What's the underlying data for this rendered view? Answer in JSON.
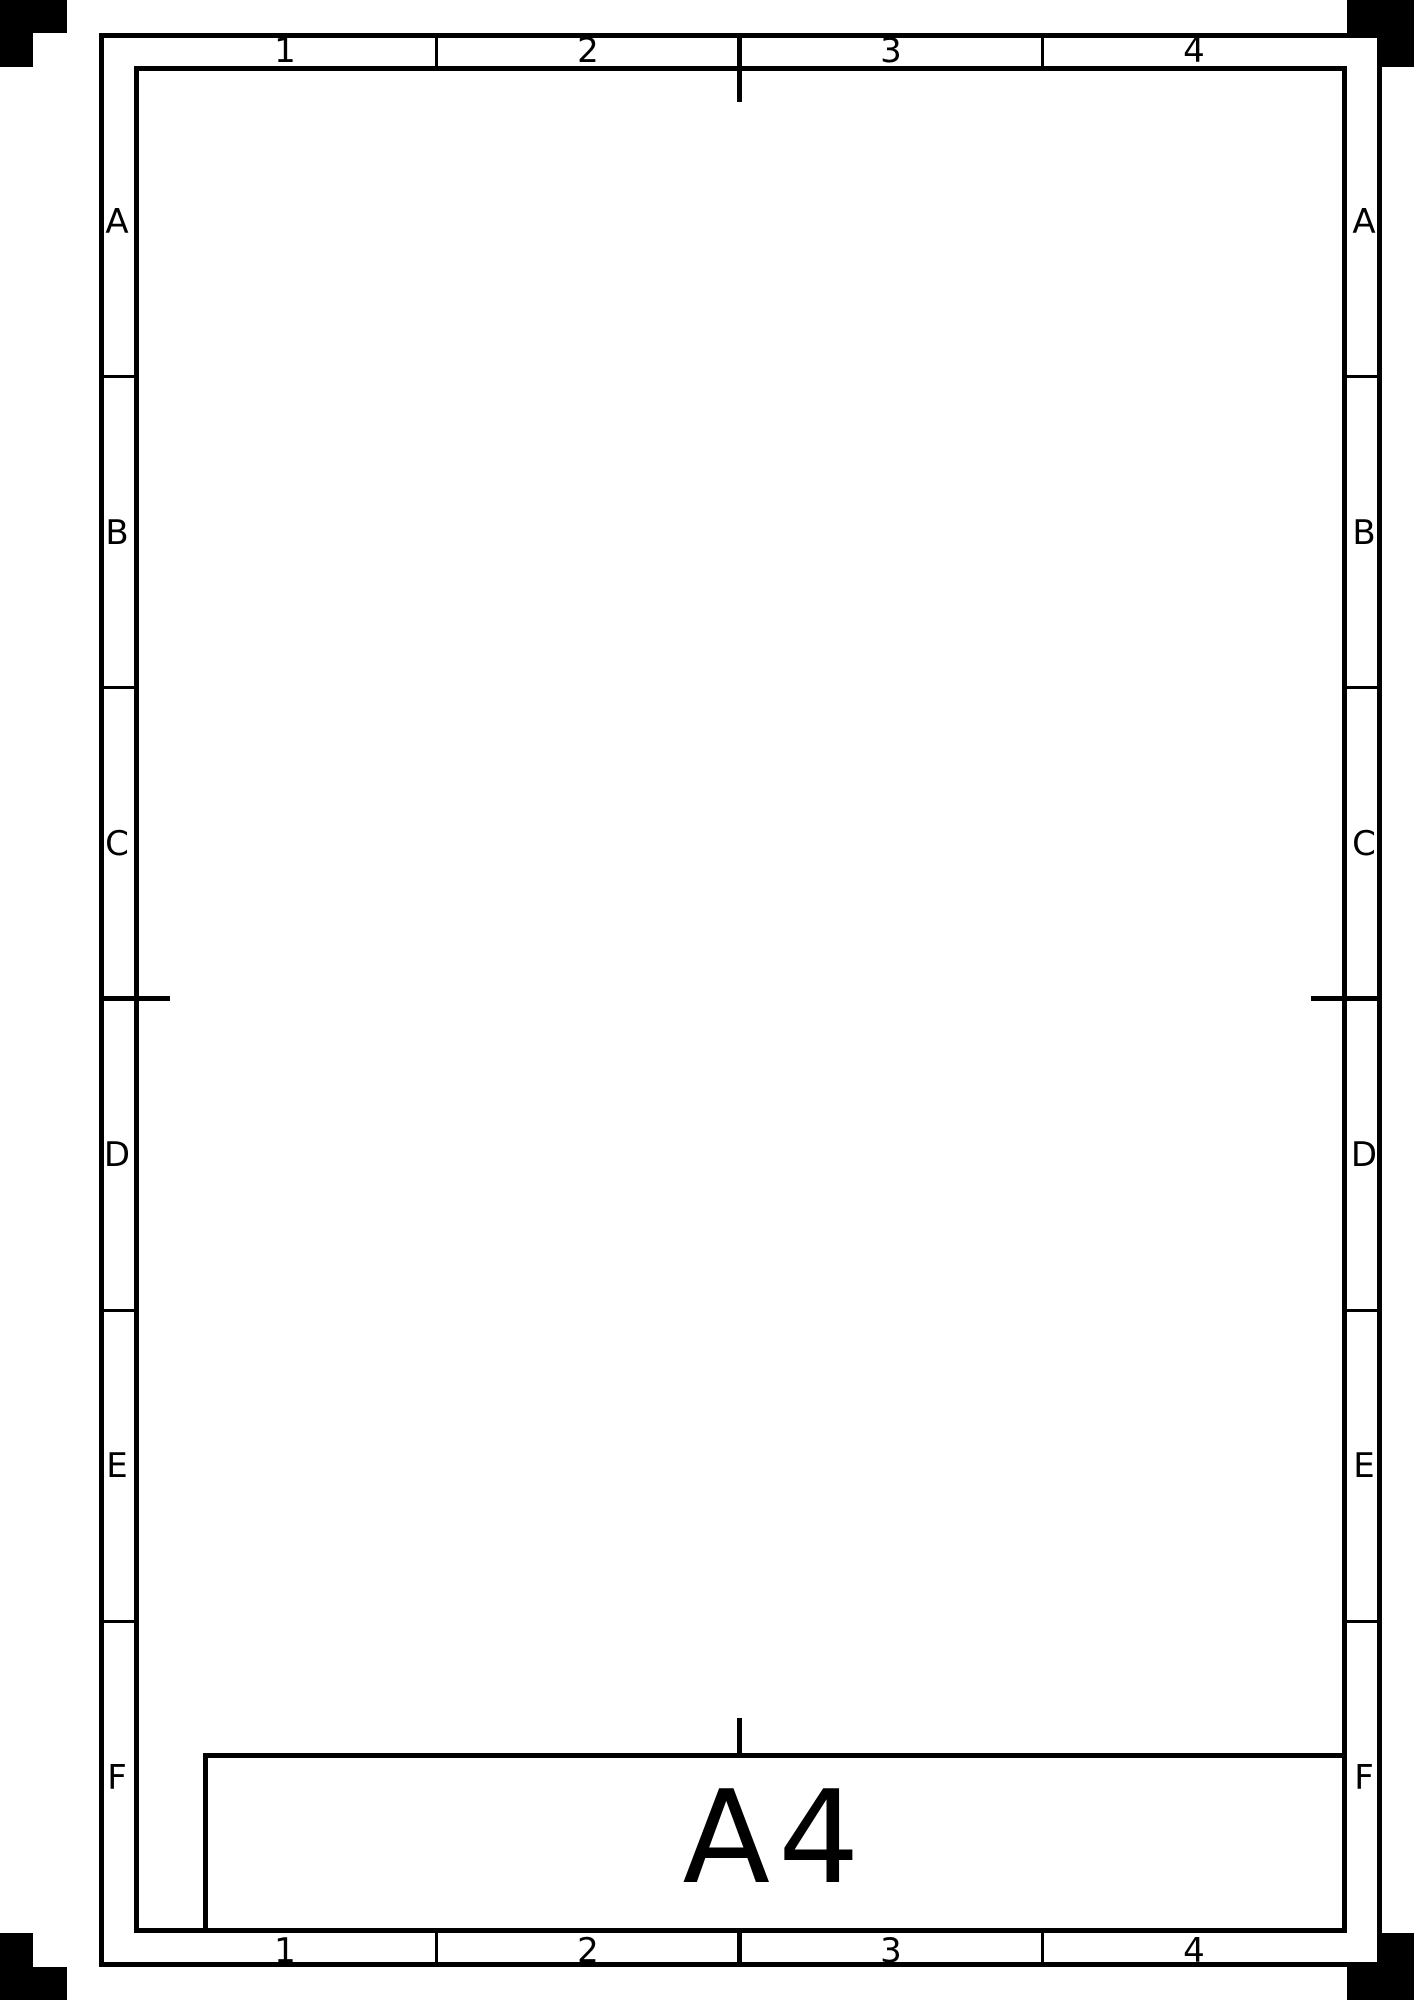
{
  "sheet": {
    "kind": "blank-a4-drawing-sheet"
  },
  "grid": {
    "columns": [
      "1",
      "2",
      "3",
      "4"
    ],
    "rows": [
      "A",
      "B",
      "C",
      "D",
      "E",
      "F"
    ]
  },
  "title_block": {
    "sheet_size": "A4"
  },
  "colors": {
    "line": "#000000",
    "background": "#ffffff"
  }
}
